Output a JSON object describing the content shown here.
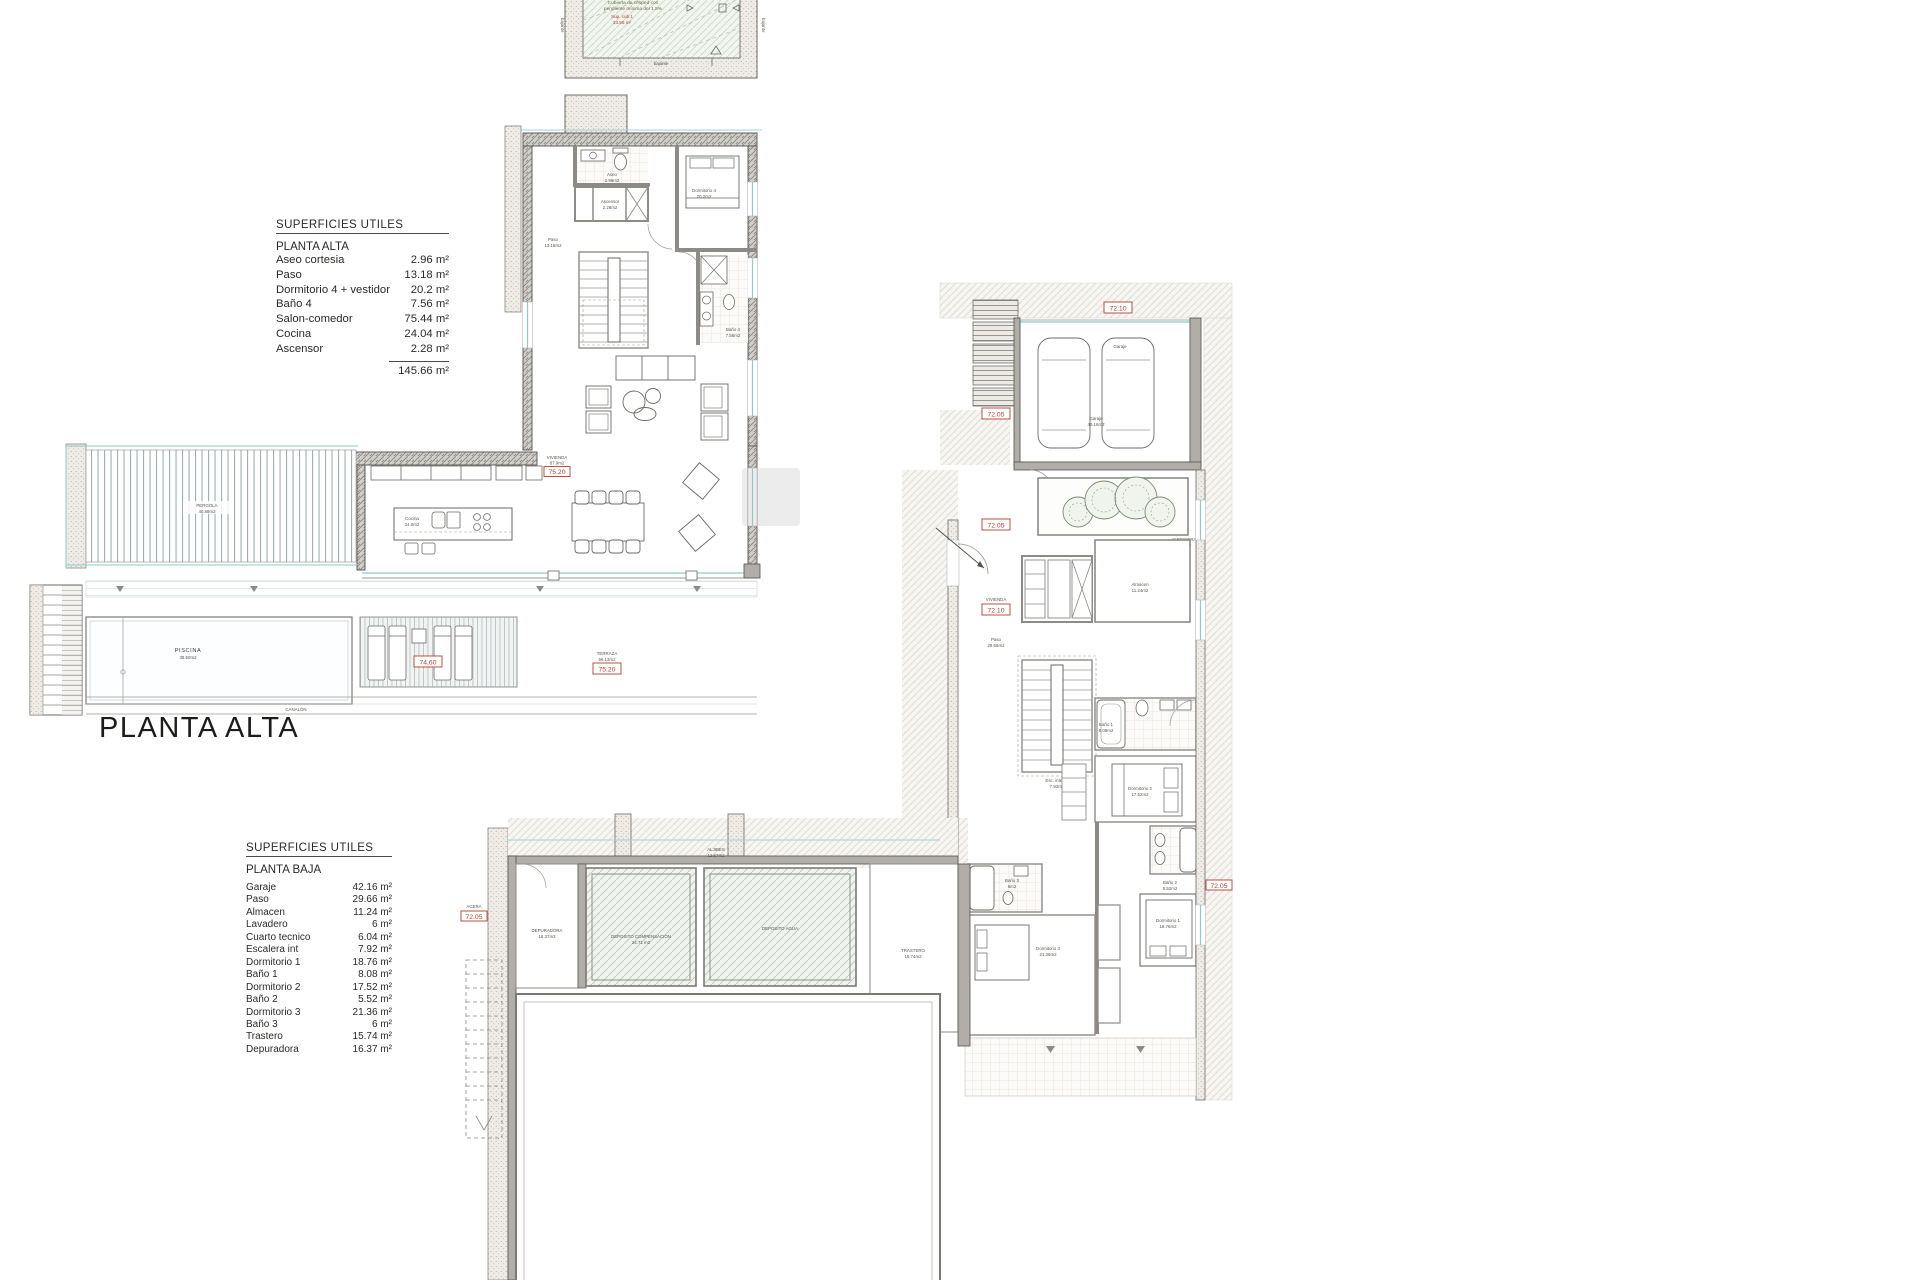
{
  "page": {
    "background": "#ffffff"
  },
  "heading": {
    "floor_title": "PLANTA ALTA"
  },
  "tables": {
    "alta": {
      "title": "SUPERFICIES UTILES",
      "subtitle": "PLANTA ALTA",
      "rows": [
        {
          "label": "Aseo cortesia",
          "value": "2.96 m²"
        },
        {
          "label": "Paso",
          "value": "13.18 m²"
        },
        {
          "label": "Dormitorio 4 + vestidor",
          "value": "20.2 m²"
        },
        {
          "label": "Baño 4",
          "value": "7.56 m²"
        },
        {
          "label": "Salon-comedor",
          "value": "75.44 m²"
        },
        {
          "label": "Cocina",
          "value": "24.04 m²"
        },
        {
          "label": "Ascensor",
          "value": "2.28 m²"
        }
      ],
      "total": "145.66 m²"
    },
    "baja": {
      "title": "SUPERFICIES UTILES",
      "subtitle": "PLANTA BAJA",
      "rows": [
        {
          "label": "Garaje",
          "value": "42.16 m²"
        },
        {
          "label": "Paso",
          "value": "29.66 m²"
        },
        {
          "label": "Almacen",
          "value": "11.24 m²"
        },
        {
          "label": "Lavadero",
          "value": "6 m²"
        },
        {
          "label": "Cuarto tecnico",
          "value": "6.04 m²"
        },
        {
          "label": "Escalera int",
          "value": "7.92 m²"
        },
        {
          "label": "Dormitorio 1",
          "value": "18.76 m²"
        },
        {
          "label": "Baño 1",
          "value": "8.08 m²"
        },
        {
          "label": "Dormitorio 2",
          "value": "17.52 m²"
        },
        {
          "label": "Baño 2",
          "value": "5.52 m²"
        },
        {
          "label": "Dormitorio 3",
          "value": "21.36 m²"
        },
        {
          "label": "Baño 3",
          "value": "6 m²"
        },
        {
          "label": "Trastero",
          "value": "15.74 m²"
        },
        {
          "label": "Depuradora",
          "value": "16.37 m²"
        }
      ]
    }
  },
  "levels": {
    "salon": "75.20",
    "terraza": "75.20",
    "deck": "74,60",
    "garage_top": "72.10",
    "entry": "72.10",
    "steps": "72.05",
    "entry_left": "72.05",
    "basement": "72.05",
    "right_edge": "72.05"
  },
  "roof": {
    "note_line1": "Cubierta de césped con",
    "note_line2": "pendiente mínima del 1.5%",
    "sup_label": "Sup. cub 1",
    "sup_value": "33.55 m²",
    "bajante": "bajante"
  },
  "alta_labels": {
    "aseo": "Aseo",
    "aseo_val": "2.96m2",
    "paso": "Paso",
    "paso_val": "13.18m2",
    "dorm4": "Dormitorio 4",
    "dorm4_val": "20.2m2",
    "ascensor": "Ascensor",
    "ascensor_val": "2.28m2",
    "bano4": "Baño 4",
    "bano4_val": "7.56m2",
    "vivienda": "VIVIENDA",
    "vivienda_val": "87.9m2",
    "cocina": "Cocina",
    "cocina_val": "24.0m2",
    "terraza": "TERRAZA",
    "terraza_val": "56.13m2",
    "piscina": "PISCINA",
    "piscina_val": "38.50m2",
    "pergola": "PERGOLA",
    "pergola_val": "40.88m2",
    "canalon": "CANALÓN"
  },
  "baja_labels": {
    "garaje": "Garaje",
    "garaje_val": "42.16m2",
    "jardinera": "JARDINERA",
    "jardinera_val": "7.18m2",
    "vivienda": "VIVIENDA",
    "paso": "Paso",
    "paso_val": "29.66m2",
    "almacen": "Almacen",
    "almacen_val": "11.24m2",
    "escalera": "Esc. interior",
    "escalera_val": "7.92m2",
    "bano1": "Baño 1",
    "bano1_val": "8.08m2",
    "dorm2": "Dormitorio 2",
    "dorm2_val": "17.52m2",
    "bano2": "Baño 2",
    "bano2_val": "5.52m2",
    "dorm1": "Dormitorio 1",
    "dorm1_val": "18.76m2",
    "bano3": "Baño 3",
    "bano3_val": "6m2",
    "dorm3": "Dormitorio 3",
    "dorm3_val": "21.36m2",
    "trastero": "TRASTERO",
    "trastero_val": "15.74m2",
    "depuradora": "DEPURADORA",
    "depuradora_val": "16.37m2",
    "dep_comp": "DEPOSITO COMPENSACION",
    "dep_comp_val": "24.71 m2",
    "dep_agua": "DEPOSITO AGUA",
    "aljibes": "ALJIBES",
    "aljibes_val": "12.57m2",
    "acera": "ACERA"
  },
  "colors": {
    "level_red": "#b0412c",
    "glass_cyan": "#8fcaca",
    "wall_gray": "#b1aeaa"
  }
}
